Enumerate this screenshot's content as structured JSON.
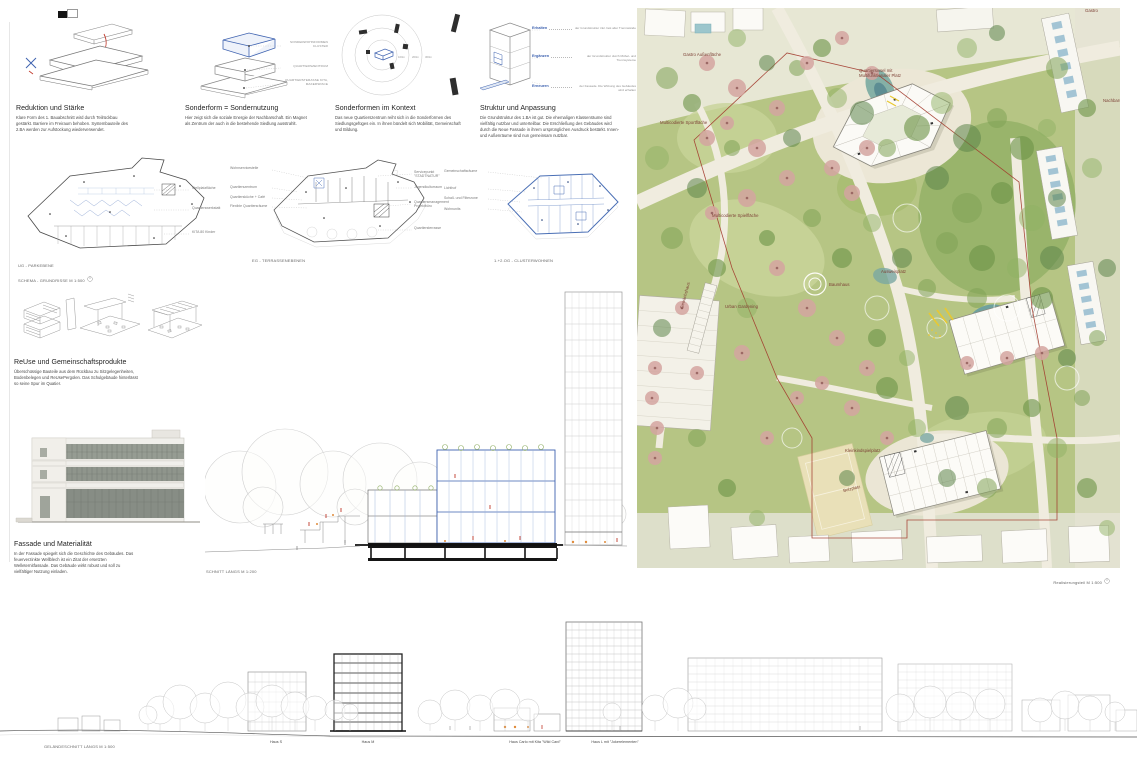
{
  "colors": {
    "accent_blue": "#3f63b0",
    "accent_red": "#c0392b",
    "boundary_red": "#a23a2c",
    "label_brown": "#7d4136",
    "water": "#6fa19e",
    "lawn": "#b6c584"
  },
  "concepts": [
    {
      "title": "Reduktion und Stärke",
      "body": "Klare Form des 1. Bauabschnitt wird durch Teilrückbau gestärkt. Barriere im Freiraum behoben. Systembauteile des 2.BA werden zur Aufstockung wiederverwendet."
    },
    {
      "title": "Sonderform = Sondernutzung",
      "body": "Hier zeigt sich die soziale Energie der Nachbarschaft. Ein Magnet als Zentrum der auch in die bestehende Siedlung ausstrahlt.",
      "callouts": [
        "SONDERWOHNFORMEN CLUSTER",
        "QUARTIERSZENTRUM",
        "QUARTIERSTERASSE KITA, MAKERSPACE"
      ]
    },
    {
      "title": "Sonderformen im Kontext",
      "body": "Das neue Quartierszentrum reiht sich in die Sonderformen des Siedlungsgefüges ein. In ihnen bündelt sich Mobilität, Gemeinschaft und Bildung.",
      "radii": [
        "100m",
        "200m",
        "300m"
      ]
    },
    {
      "title": "Struktur und Anpassung",
      "body": "Die Grundstruktur des 1.BA ist gut. Die ehemaligen Klassenräume sind vielfältig nutzbar und unterteilbar. Die Erschließung des Gebäudes wird durch die Neue Fassade in ihrem ursprünglichen Ausdruck bestärkt. Innen- und Außenräume sind nun gemeinsam nutzbar.",
      "steps": [
        {
          "label": "Erhalten",
          "desc": "der Grundstruktur inkl. fast aller Trennwände"
        },
        {
          "label": "Ergänzen",
          "desc": "der Grundstruktur durch Möbel- und Trennsysteme"
        },
        {
          "label": "Erneuern",
          "desc": "der Fassade. Die Wirkung des Gebäudes wird erhalten"
        }
      ]
    }
  ],
  "plans": [
    {
      "caption1": "UG - PARKEBENE",
      "caption2": "SCHEMA - GRUNDRISSE M 1:500",
      "labels_right": [
        "Stellplatzfläche",
        "Quartierswerkstatt",
        "KITA 80 Kinder"
      ]
    },
    {
      "caption": "EG - TERRASSENEBENEN",
      "labels_left": [
        "Wohnservicestelle",
        "Quartierszentrum",
        "Quartiersküche + Café",
        "Flexible Quartiersräume"
      ],
      "labels_right": [
        "Servicepunkt \"STADTNATUR\"",
        "Jugendkulturraum",
        "Quartiersmanagement Projektbüro",
        "Quartiersterrasse"
      ]
    },
    {
      "caption": "1.+2.OG - CLUSTERWOHNEN",
      "labels_left": [
        "Gemeinschaftsräume",
        "Lichthof",
        "Schall- und Filterzone",
        "Wohnunits"
      ]
    }
  ],
  "reuse": {
    "title": "ReUse und Gemeinschaftsprodukte",
    "body": "Überschüssige Bauteile aus dem Rückbau zu Sitzgelegenheiten, Bodenbelegen und ReUsePergolen. Das Schulgebäude hinterlässt so seine Spur im Quatier."
  },
  "fassade": {
    "title": "Fassade und Materialität",
    "body": "In der Fassade spiegelt sich die Geschichte des Gebäudes. Das feuerverzinkte Wellblech ist ein Zitat der ersetzten Welleternitfassade. Das Gebäude wirkt robust und soll zu vielfältiger Nutzung einladen."
  },
  "schnitt": {
    "caption": "SCHNITT LÄNGS M 1:200"
  },
  "terrain": {
    "caption": "GELÄNDESCHNITT LÄNGS M 1:500",
    "houses": [
      "Haus S",
      "Haus M",
      "Haus Carlo mit Kita \"Wild Card\"",
      "Haus L mit \"Jokerelementen\""
    ]
  },
  "siteplan": {
    "caption": "Realisierungsteil M 1:500",
    "labels": {
      "gastro_area": "Gastro Außenfläche",
      "gastro": "Gastro",
      "insel": "Quartiersinsel mit Multifunktionaler Platz",
      "sport": "Multicodierte Sportfläche",
      "spiel": "Multicodierte Spielfläche",
      "urban": "Urban Gardening",
      "baumhaus": "Baumhaus",
      "gewaechshaus": "Gewächshaus",
      "ausweis": "Ausweisplatz",
      "kleinkind": "Kleinkindspielplatz",
      "bolz": "Bolzplatz",
      "nachbar": "Nachbarschaft"
    }
  }
}
